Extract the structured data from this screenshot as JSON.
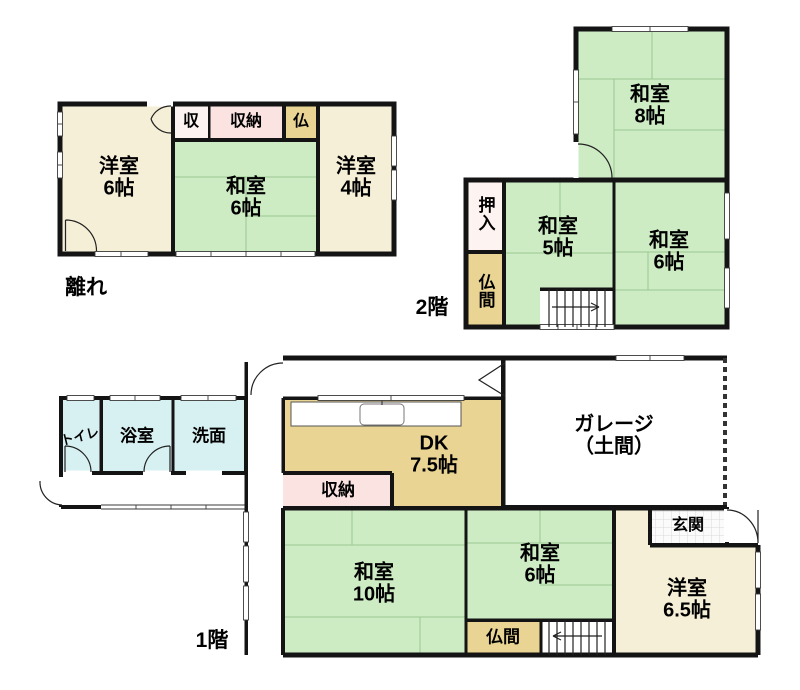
{
  "colors": {
    "green": "#cdecc4",
    "cream": "#f6efd7",
    "pink": "#fbe3e1",
    "closet_light": "#fdf3f0",
    "tan": "#e9d494",
    "cyan": "#d7f0f2",
    "wall": "#141414"
  },
  "hanare": {
    "label": "離れ",
    "rooms": {
      "yoshitsu6": {
        "name": "洋室",
        "size": "6帖"
      },
      "shu": {
        "name": "収"
      },
      "shuno": {
        "name": "収納"
      },
      "butsu": {
        "name": "仏"
      },
      "washitsu6": {
        "name": "和室",
        "size": "6帖"
      },
      "yoshitsu4": {
        "name": "洋室",
        "size": "4帖"
      }
    }
  },
  "floor2": {
    "label": "2階",
    "rooms": {
      "washitsu8": {
        "name": "和室",
        "size": "8帖"
      },
      "oshiire": {
        "name": "押入"
      },
      "butsuma": {
        "name": "仏間"
      },
      "washitsu5": {
        "name": "和室",
        "size": "5帖"
      },
      "washitsu6": {
        "name": "和室",
        "size": "6帖"
      }
    }
  },
  "floor1": {
    "label": "1階",
    "rooms": {
      "toilet": {
        "name": "トイレ"
      },
      "bath": {
        "name": "浴室"
      },
      "senmen": {
        "name": "洗面"
      },
      "dk": {
        "name": "DK",
        "size": "7.5帖"
      },
      "shuno": {
        "name": "収納"
      },
      "garage": {
        "name": "ガレージ",
        "size": "（土間）"
      },
      "genkan": {
        "name": "玄関"
      },
      "washitsu10": {
        "name": "和室",
        "size": "10帖"
      },
      "washitsu6": {
        "name": "和室",
        "size": "6帖"
      },
      "butsuma": {
        "name": "仏間"
      },
      "yoshitsu65": {
        "name": "洋室",
        "size": "6.5帖"
      }
    }
  }
}
